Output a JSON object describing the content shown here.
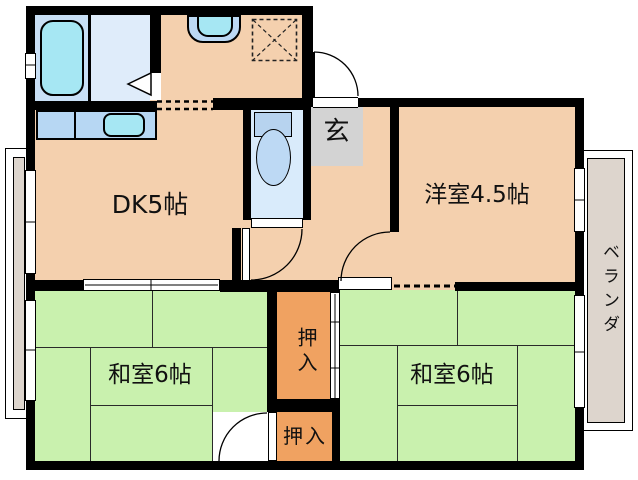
{
  "title": "2DK apartment floor plan",
  "rooms": {
    "dk": {
      "label": "DK5帖"
    },
    "western": {
      "label": "洋室4.5帖"
    },
    "tatami_left": {
      "label": "和室6帖"
    },
    "tatami_right": {
      "label": "和室6帖"
    },
    "genkan": {
      "label": "玄"
    },
    "closet_upper": {
      "label": "押入"
    },
    "closet_lower": {
      "label": "押入"
    },
    "veranda": {
      "label": "ベランダ"
    }
  },
  "fixtures": [
    "bathtub",
    "kitchen-sink",
    "counter-sink",
    "toilet",
    "appliance-space"
  ],
  "colors": {
    "wall": "#000000",
    "room_peach": "#f4d0ae",
    "tatami_green": "#c9f1ae",
    "closet_orange": "#f0a261",
    "genkan_gray": "#d3d3d3",
    "balcony_gray": "#ddd5cd",
    "bath_floor": "#c9e0f6",
    "washroom_floor": "#dfecfa",
    "toilet_floor": "#d9ebfb",
    "fixture_blue": "#b7d7f3",
    "water_cyan": "#a6e7f3"
  }
}
